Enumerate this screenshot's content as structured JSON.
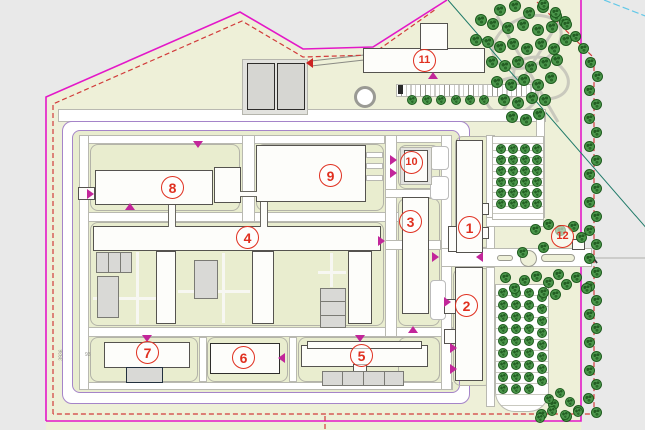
{
  "plan": {
    "colors": {
      "background_gray": "#e9e9e9",
      "site_green": "#eef0d8",
      "campus_green": "#e9edcf",
      "boundary_magenta": "#e318c8",
      "boundary_red_dashed": "#d23b3b",
      "fence_purple": "#a584c9",
      "survey_teal": "#1f7a68",
      "survey_cyan": "#62c8e8",
      "road_white": "#ffffff",
      "building_white": "#fdfdfa",
      "gray_box": "#d9d9d6",
      "tree_green": "#4b964b",
      "label_red": "#e03020"
    },
    "building_labels": [
      {
        "n": "1",
        "x": 470,
        "y": 228
      },
      {
        "n": "2",
        "x": 467,
        "y": 306
      },
      {
        "n": "3",
        "x": 411,
        "y": 222
      },
      {
        "n": "4",
        "x": 248,
        "y": 238
      },
      {
        "n": "5",
        "x": 362,
        "y": 356
      },
      {
        "n": "6",
        "x": 244,
        "y": 358
      },
      {
        "n": "7",
        "x": 148,
        "y": 353
      },
      {
        "n": "8",
        "x": 173,
        "y": 188
      },
      {
        "n": "9",
        "x": 331,
        "y": 176
      },
      {
        "n": "10",
        "x": 412,
        "y": 163
      },
      {
        "n": "11",
        "x": 425,
        "y": 61
      },
      {
        "n": "12",
        "x": 563,
        "y": 237
      }
    ],
    "dimensions": [
      {
        "text": "3936",
        "x": 56,
        "y": 352,
        "vertical": true
      },
      {
        "text": "93",
        "x": 85,
        "y": 352,
        "vertical": false
      }
    ],
    "arrows": [
      {
        "x": 198,
        "y": 146,
        "dir": "down"
      },
      {
        "x": 130,
        "y": 208,
        "dir": "up"
      },
      {
        "x": 92,
        "y": 194,
        "dir": "right"
      },
      {
        "x": 433,
        "y": 77,
        "dir": "up"
      },
      {
        "x": 395,
        "y": 160,
        "dir": "right"
      },
      {
        "x": 395,
        "y": 173,
        "dir": "right"
      },
      {
        "x": 383,
        "y": 241,
        "dir": "right"
      },
      {
        "x": 437,
        "y": 257,
        "dir": "right"
      },
      {
        "x": 481,
        "y": 257,
        "dir": "left"
      },
      {
        "x": 449,
        "y": 302,
        "dir": "right"
      },
      {
        "x": 455,
        "y": 348,
        "dir": "right"
      },
      {
        "x": 455,
        "y": 369,
        "dir": "right"
      },
      {
        "x": 283,
        "y": 358,
        "dir": "left"
      },
      {
        "x": 360,
        "y": 340,
        "dir": "down"
      },
      {
        "x": 147,
        "y": 340,
        "dir": "down"
      },
      {
        "x": 413,
        "y": 331,
        "dir": "up"
      },
      {
        "x": 311,
        "y": 63,
        "dir": "left",
        "color": "#cc2222"
      }
    ],
    "trees": [
      {
        "name": "park-top-right-tree",
        "size": 12,
        "points": [
          [
            500,
            10
          ],
          [
            515,
            6
          ],
          [
            529,
            13
          ],
          [
            543,
            7
          ],
          [
            556,
            16
          ],
          [
            481,
            20
          ],
          [
            493,
            24
          ],
          [
            508,
            28
          ],
          [
            523,
            25
          ],
          [
            538,
            30
          ],
          [
            552,
            27
          ],
          [
            565,
            22
          ],
          [
            476,
            40
          ],
          [
            488,
            42
          ],
          [
            500,
            47
          ],
          [
            513,
            44
          ],
          [
            527,
            49
          ],
          [
            541,
            44
          ],
          [
            554,
            49
          ],
          [
            566,
            40
          ],
          [
            492,
            62
          ],
          [
            505,
            66
          ],
          [
            518,
            62
          ],
          [
            531,
            67
          ],
          [
            545,
            63
          ],
          [
            557,
            60
          ],
          [
            497,
            82
          ],
          [
            511,
            85
          ],
          [
            524,
            80
          ],
          [
            538,
            85
          ],
          [
            551,
            78
          ],
          [
            504,
            100
          ],
          [
            518,
            103
          ],
          [
            532,
            98
          ],
          [
            545,
            100
          ],
          [
            512,
            117
          ],
          [
            526,
            120
          ],
          [
            539,
            114
          ]
        ]
      },
      {
        "name": "boundary-right-tree",
        "size": 11,
        "points": [
          [
            543,
            4
          ],
          [
            555,
            12
          ],
          [
            566,
            24
          ],
          [
            575,
            36
          ],
          [
            583,
            48
          ],
          [
            590,
            62
          ],
          [
            597,
            76
          ],
          [
            589,
            90
          ],
          [
            596,
            104
          ],
          [
            589,
            118
          ],
          [
            596,
            132
          ],
          [
            589,
            146
          ],
          [
            596,
            160
          ],
          [
            589,
            174
          ],
          [
            596,
            188
          ],
          [
            589,
            202
          ],
          [
            596,
            216
          ],
          [
            589,
            230
          ],
          [
            596,
            244
          ],
          [
            589,
            258
          ],
          [
            596,
            272
          ],
          [
            589,
            286
          ],
          [
            596,
            300
          ],
          [
            589,
            314
          ],
          [
            596,
            328
          ],
          [
            589,
            342
          ],
          [
            596,
            356
          ],
          [
            589,
            370
          ],
          [
            596,
            384
          ],
          [
            588,
            398
          ],
          [
            578,
            410
          ],
          [
            566,
            416
          ],
          [
            553,
            404
          ],
          [
            541,
            414
          ],
          [
            596,
            412
          ]
        ]
      },
      {
        "name": "parking-mid-tree",
        "size": 10,
        "points": [
          [
            501,
            149
          ],
          [
            513,
            149
          ],
          [
            525,
            149
          ],
          [
            537,
            149
          ],
          [
            501,
            160
          ],
          [
            513,
            160
          ],
          [
            525,
            160
          ],
          [
            537,
            160
          ],
          [
            501,
            171
          ],
          [
            513,
            171
          ],
          [
            525,
            171
          ],
          [
            537,
            171
          ],
          [
            501,
            182
          ],
          [
            513,
            182
          ],
          [
            525,
            182
          ],
          [
            537,
            182
          ],
          [
            501,
            193
          ],
          [
            513,
            193
          ],
          [
            525,
            193
          ],
          [
            537,
            193
          ],
          [
            501,
            204
          ],
          [
            513,
            204
          ],
          [
            525,
            204
          ],
          [
            537,
            204
          ]
        ]
      },
      {
        "name": "parking-bottom-tree",
        "size": 10,
        "points": [
          [
            503,
            293
          ],
          [
            516,
            293
          ],
          [
            529,
            293
          ],
          [
            503,
            305
          ],
          [
            516,
            305
          ],
          [
            529,
            305
          ],
          [
            503,
            317
          ],
          [
            516,
            317
          ],
          [
            529,
            317
          ],
          [
            503,
            329
          ],
          [
            516,
            329
          ],
          [
            529,
            329
          ],
          [
            503,
            341
          ],
          [
            516,
            341
          ],
          [
            529,
            341
          ],
          [
            503,
            353
          ],
          [
            516,
            353
          ],
          [
            529,
            353
          ],
          [
            503,
            365
          ],
          [
            516,
            365
          ],
          [
            529,
            365
          ],
          [
            503,
            377
          ],
          [
            516,
            377
          ],
          [
            529,
            377
          ],
          [
            503,
            389
          ],
          [
            516,
            389
          ],
          [
            529,
            389
          ],
          [
            542,
            297
          ],
          [
            542,
            309
          ],
          [
            542,
            321
          ],
          [
            542,
            333
          ],
          [
            542,
            345
          ],
          [
            542,
            357
          ],
          [
            542,
            369
          ],
          [
            542,
            381
          ],
          [
            549,
            399
          ],
          [
            560,
            393
          ],
          [
            570,
            402
          ],
          [
            578,
            412
          ],
          [
            565,
            415
          ],
          [
            552,
            411
          ],
          [
            540,
            418
          ]
        ]
      },
      {
        "name": "entrance-tree",
        "size": 11,
        "points": [
          [
            535,
            229
          ],
          [
            548,
            224
          ],
          [
            560,
            230
          ],
          [
            573,
            226
          ],
          [
            581,
            237
          ],
          [
            543,
            247
          ],
          [
            522,
            252
          ],
          [
            505,
            277
          ],
          [
            514,
            288
          ],
          [
            524,
            280
          ],
          [
            536,
            276
          ],
          [
            548,
            282
          ],
          [
            558,
            274
          ],
          [
            566,
            284
          ],
          [
            576,
            277
          ],
          [
            586,
            288
          ],
          [
            555,
            294
          ],
          [
            543,
            292
          ]
        ]
      },
      {
        "name": "parkstrip-tree",
        "size": 10,
        "points": [
          [
            412,
            100
          ],
          [
            427,
            100
          ],
          [
            441,
            100
          ],
          [
            456,
            100
          ],
          [
            470,
            100
          ],
          [
            484,
            100
          ]
        ]
      }
    ]
  }
}
